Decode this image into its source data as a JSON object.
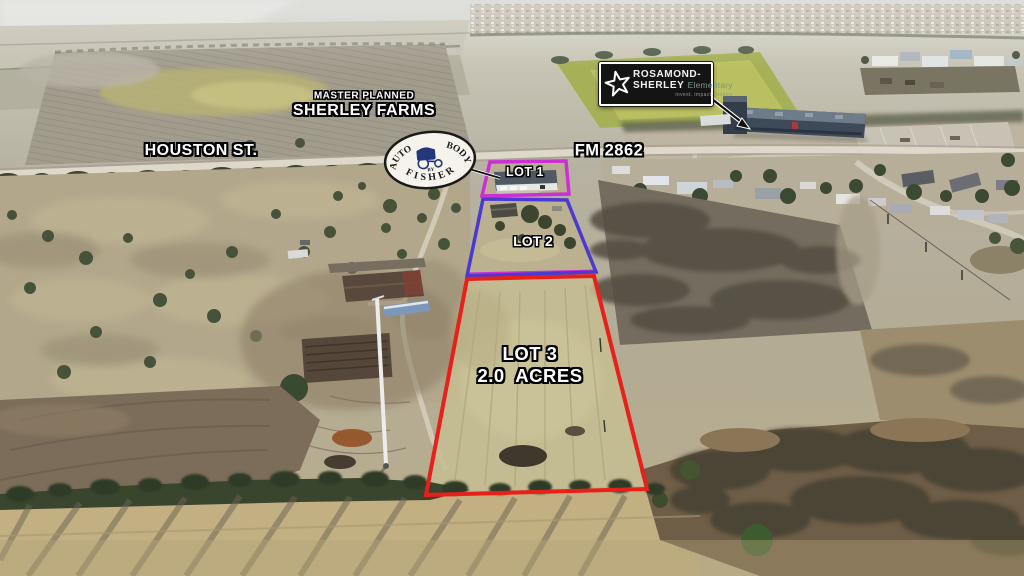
{
  "scene": {
    "labels": {
      "master_planned": "MASTER PLANNED",
      "sherley_farms": "SHERLEY FARMS",
      "houston_st": "HOUSTON ST.",
      "fm_road": "FM 2862",
      "lot1": "LOT 1",
      "lot2": "LOT 2",
      "lot3": "LOT 3",
      "lot3_acres": "2.0  ACRES"
    },
    "school_sign": {
      "name_line1": "ROSAMOND-",
      "name_line2": "SHERLEY",
      "name_suffix": "Elementary",
      "tagline": "invest. impact. inspire"
    },
    "auto_logo": {
      "top_left": "AUTO",
      "top_right": "BODY",
      "middle": "BY",
      "bottom": "FISHER"
    },
    "colors": {
      "lot1_outline": "#cc2fd6",
      "lot2_outline": "#4a3ad0",
      "lot3_outline": "#e8201a",
      "label_text": "#ffffff"
    }
  }
}
